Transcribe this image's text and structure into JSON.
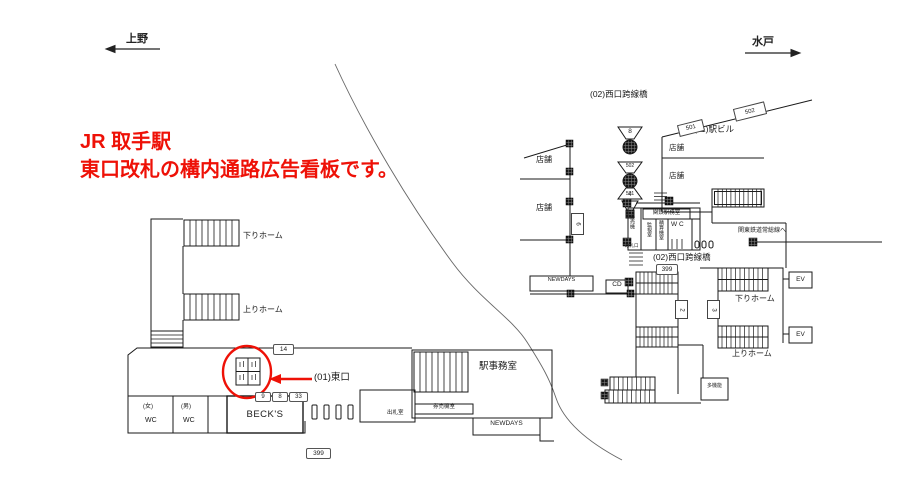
{
  "colors": {
    "annotation_red": "#ee1107",
    "line": "#1a1a1a"
  },
  "directions": {
    "to_ueno": "上野",
    "to_mito": "水戸"
  },
  "title": {
    "line1": "JR 取手駅",
    "line2": "東口改札の構内通路広告看板です。"
  },
  "left_map": {
    "down_platform": "下りホーム",
    "up_platform": "上りホーム",
    "tag_14": "14",
    "tag_9": "9",
    "tag_8": "8",
    "tag_33": "33",
    "tag_399": "399",
    "wc_women_label": "(女)",
    "wc_women": "WC",
    "wc_men_label": "(男)",
    "wc_men": "WC",
    "becks": "BECK'S",
    "ticket_window": "出札室",
    "ticket_machine_room": "券売機室",
    "station_office": "駅事務室",
    "newdays": "NEWDAYS",
    "east_exit_callout": "(01)東口"
  },
  "right_map": {
    "overpass_top": "(02)西口跨線橋",
    "overpass_mid": "(02)西口跨線橋",
    "shop1": "店舗",
    "shop2": "店舗",
    "shop3": "店舗",
    "shop4": "店舗",
    "station_building": "(11)駅ビル",
    "roof_tag_501": "501",
    "roof_tag_502": "502",
    "board_8": "8",
    "board_502": "502",
    "board_501": "501",
    "board_4": "4",
    "tag_6": "6",
    "tag_2": "2",
    "tag_3": "3",
    "tag_399": "399",
    "kantetsu_office": "関鉄駅務室",
    "ticket_machines": "券売機",
    "monitor_room": "監視室",
    "fare_adjust_room": "精算機室",
    "wc": "W C",
    "gate": "改札口",
    "joso_line": "関東鉄道常総線へ",
    "newdays": "NEWDAYS",
    "cd": "CD",
    "down_platform": "下りホーム",
    "up_platform": "上りホーム",
    "ev1": "EV",
    "ev2": "EV",
    "multifunction": "多機能"
  }
}
